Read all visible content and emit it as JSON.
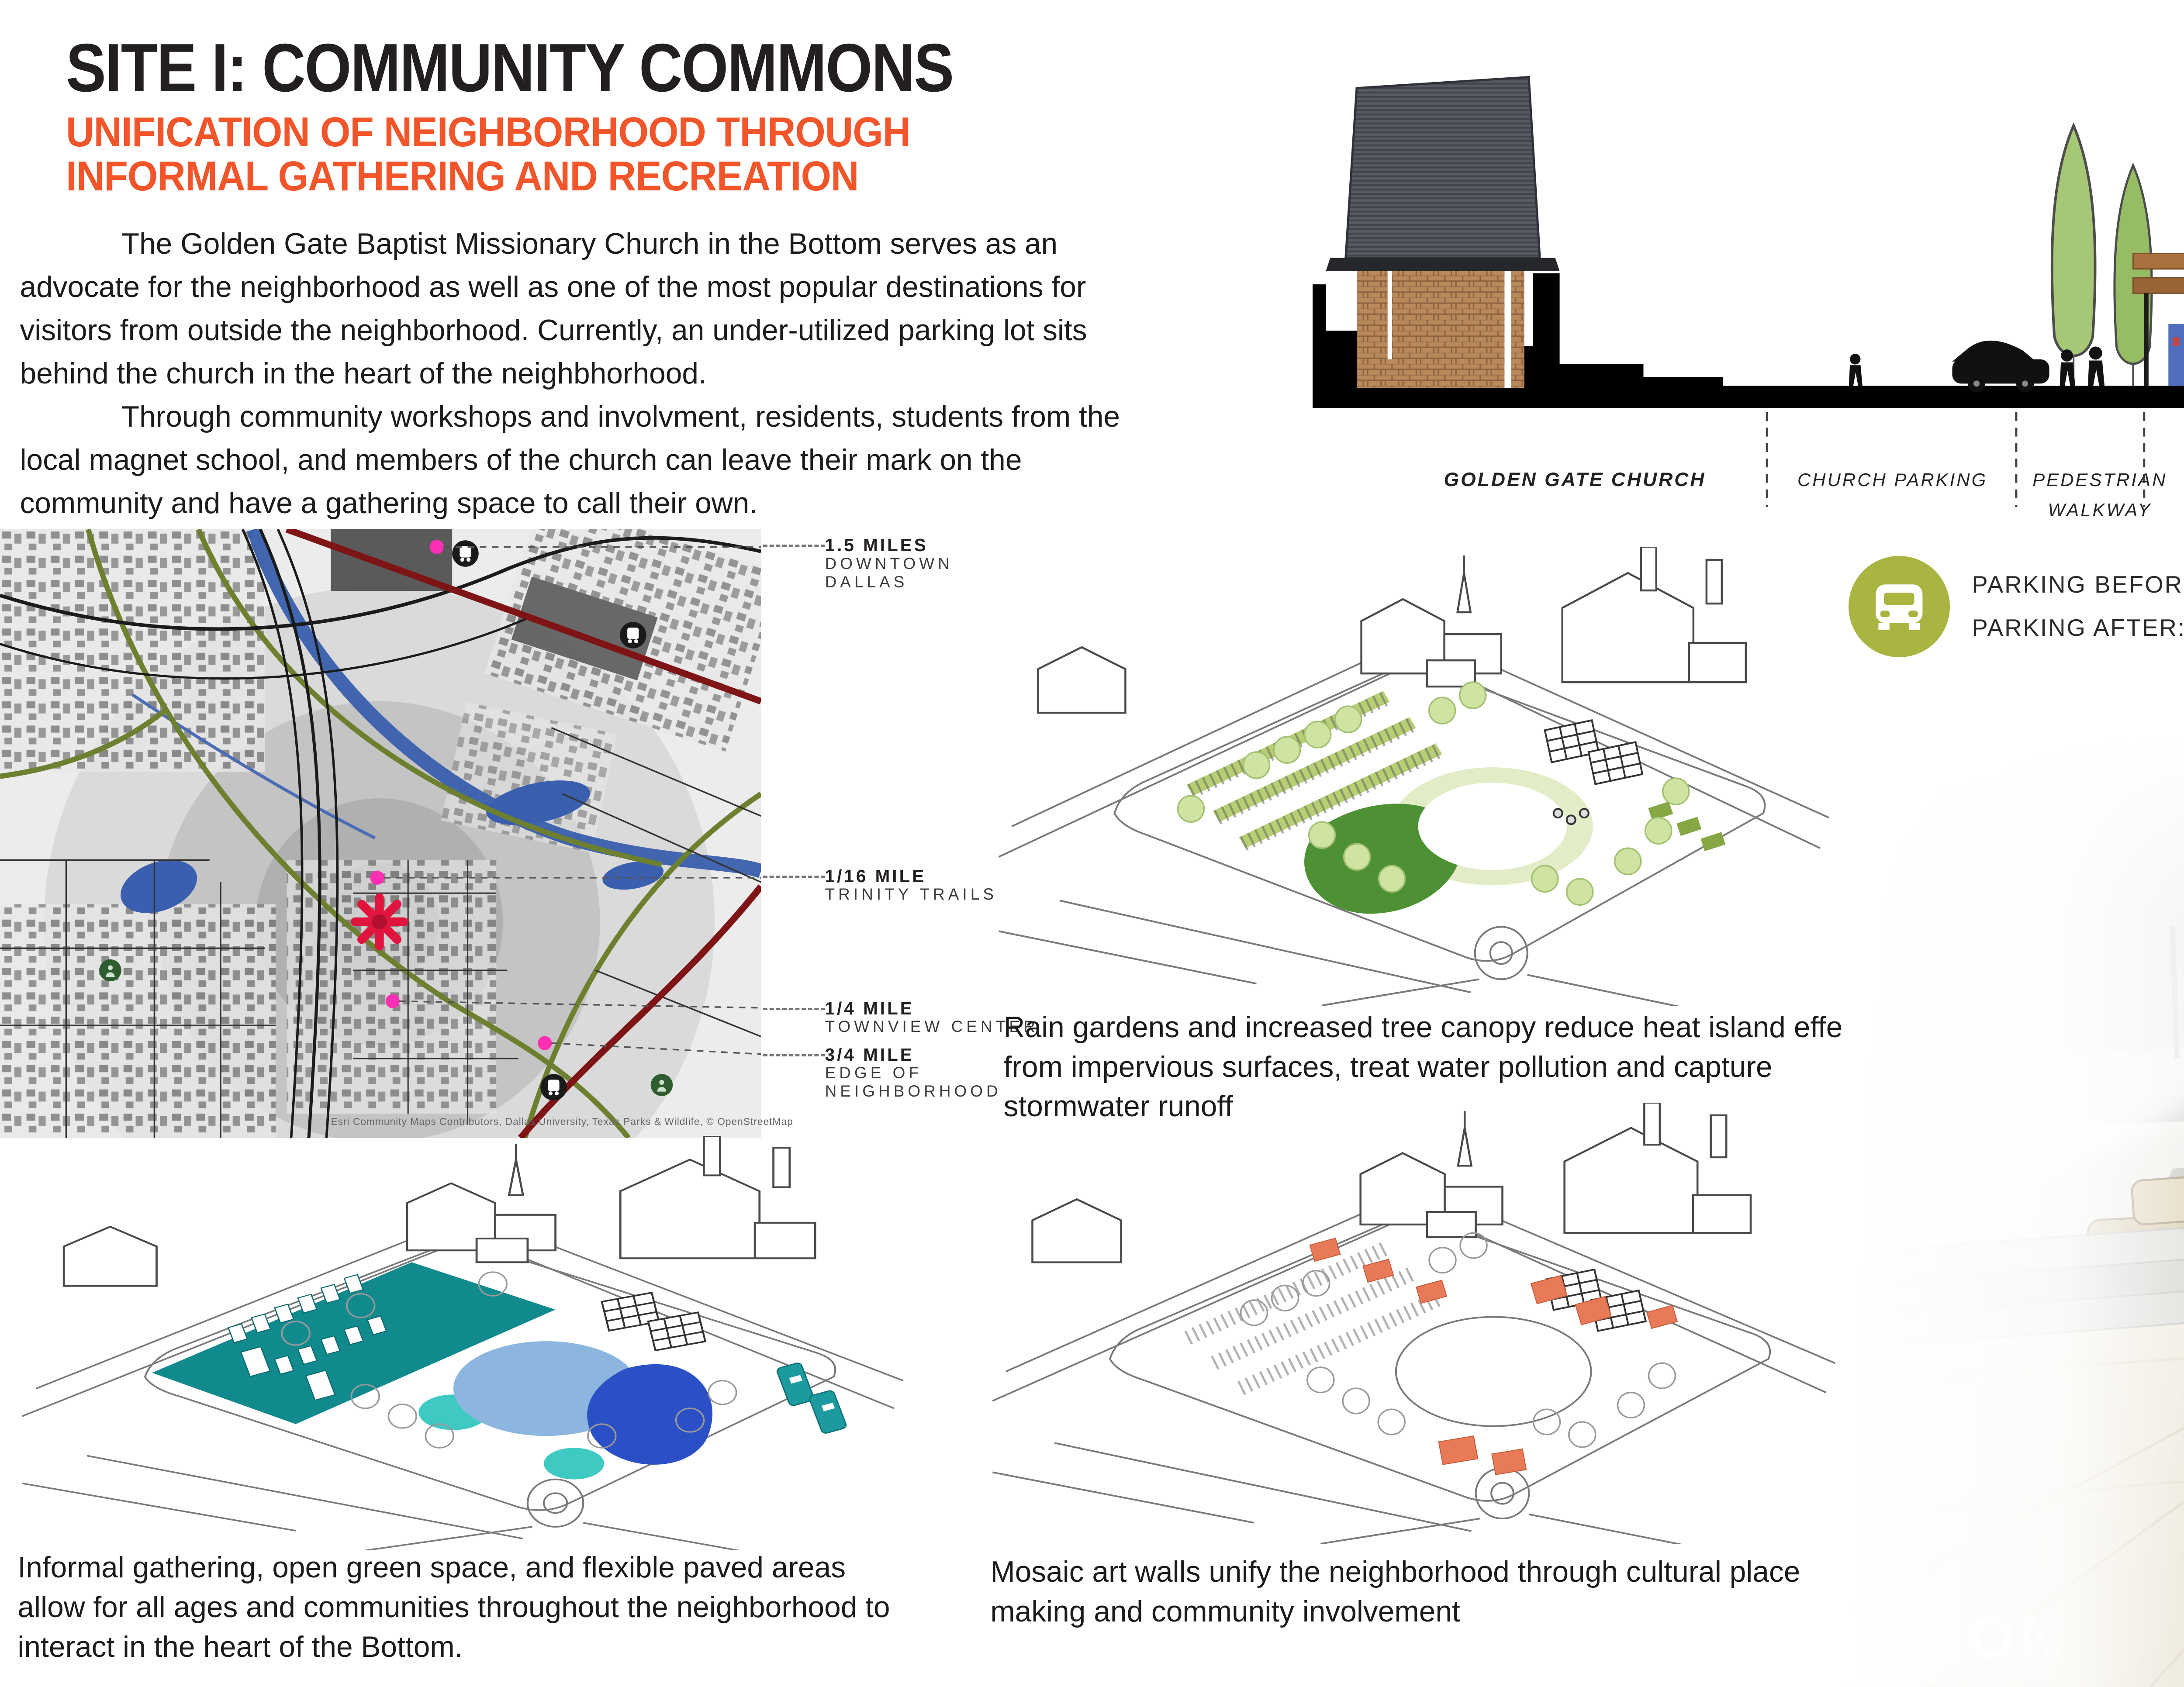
{
  "colors": {
    "accent_orange": "#f2552a",
    "stat_green": "#a9b441",
    "stat_orange": "#f04e23",
    "stat_blue": "#1a78bf"
  },
  "header": {
    "title": "SITE I: COMMUNITY COMMONS",
    "subtitle_line1": "UNIFICATION OF NEIGHBORHOOD THROUGH",
    "subtitle_line2": "INFORMAL GATHERING AND RECREATION"
  },
  "intro": {
    "para1": "The Golden Gate Baptist Missionary Church in the Bottom serves as an advocate for the neighborhood as well as one of the most popular destinations for visitors from outside the neighborhood. Currently, an under-utilized parking lot sits behind the church in the heart of the neighbhorhood.",
    "para2": "Through community workshops and involvment, residents, students from the local magnet school, and members of the church can leave their mark on the community and have a gathering space to call their own."
  },
  "section_diagram": {
    "labels": [
      {
        "text": "GOLDEN GATE CHURCH"
      },
      {
        "text": "CHURCH PARKING"
      },
      {
        "text": "PEDESTRIAN",
        "text2": "WALKWAY"
      },
      {
        "text": "PAVILION"
      },
      {
        "text": "OPEN LAWN"
      },
      {
        "text": "RAIN",
        "text2": "GARDEN"
      },
      {
        "text": "SHADED SEATING"
      },
      {
        "text": "CLIFF STREET"
      }
    ]
  },
  "stats": [
    {
      "icon": "car-icon",
      "line1": "PARKING BEFORE: 118 SPACES",
      "line2": "PARKING AFTER: 66 SPACES"
    },
    {
      "icon": "community-icon",
      "line1": "COMMUNITY BUILDING AND",
      "line2": "DESIGN OPPORTUNIY"
    },
    {
      "icon": "water-drop-icon",
      "line1": "45, 843 GALLONS OF WATER",
      "line2": "CAPTURED BY RAIN GARDENS"
    }
  ],
  "map": {
    "markers": [
      {
        "distance": "1.5 MILES",
        "place1": "DOWNTOWN",
        "place2": "DALLAS"
      },
      {
        "distance": "1/16 MILE",
        "place1": "TRINITY TRAILS"
      },
      {
        "distance": "1/4 MILE",
        "place1": "TOWNVIEW CENTER"
      },
      {
        "distance": "3/4 MILE",
        "place1": "EDGE OF",
        "place2": "NEIGHBORHOOD"
      }
    ],
    "attribution": "Esri Community Maps Contributors, Dallas University, Texas Parks & Wildlife, © OpenStreetMap"
  },
  "captions": {
    "rain_gardens": "Rain gardens and increased tree canopy reduce heat island effect from impervious surfaces, treat water pollution and capture stormwater runoff",
    "informal": "Informal gathering, open green space, and flexible paved areas allow for all ages and communities throughout the neighborhood to interact in the heart of the Bottom.",
    "mosaic": "Mosaic art walls unify the neighborhood through cultural place making and community involvement"
  },
  "render": {
    "watermark": "UMION"
  }
}
